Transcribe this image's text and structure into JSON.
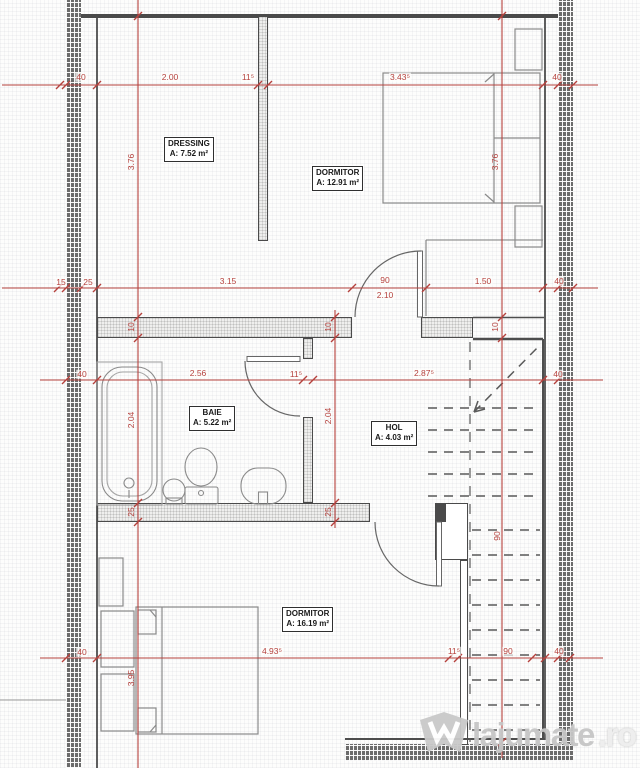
{
  "rooms": {
    "dressing": {
      "name": "DRESSING",
      "area": "A: 7.52 m²"
    },
    "dormitor_top": {
      "name": "DORMITOR",
      "area": "A: 12.91 m²"
    },
    "baie": {
      "name": "BAIE",
      "area": "A: 5.22 m²"
    },
    "hol": {
      "name": "HOL",
      "area": "A: 4.03 m²"
    },
    "dormitor_bottom": {
      "name": "DORMITOR",
      "area": "A: 16.19 m²"
    }
  },
  "dims": {
    "h_top": {
      "a": "40",
      "b": "2.00",
      "c": "11⁵",
      "d": "3.43⁵",
      "e": "40"
    },
    "h_mid": {
      "a": "15",
      "b": "25",
      "c": "3.15",
      "d": "90",
      "d2": "2.10",
      "e": "1.50",
      "f": "40"
    },
    "h_bath": {
      "a": "40",
      "b": "2.56",
      "c": "11⁵",
      "d": "2.87⁵",
      "e": "40"
    },
    "h_bottom": {
      "a": "40",
      "b": "4.93⁵",
      "c": "11⁵",
      "d": "90",
      "e": "40"
    },
    "v_left": {
      "a": "3.76",
      "b": "10",
      "c": "2.04",
      "d": "25",
      "e": "3.95"
    },
    "v_mid": {
      "b": "10",
      "c": "2.04",
      "d": "25"
    },
    "v_right": {
      "a": "3.76",
      "b": "10",
      "c": "90"
    }
  },
  "watermark": {
    "brand": "lajumate",
    "tld": ".ro",
    "logo": "lajumate-crown-icon"
  },
  "colors": {
    "dimension_red": "#b5413d",
    "wall_dark": "#4a4a4a",
    "furniture_gray": "#8a8a8a"
  }
}
